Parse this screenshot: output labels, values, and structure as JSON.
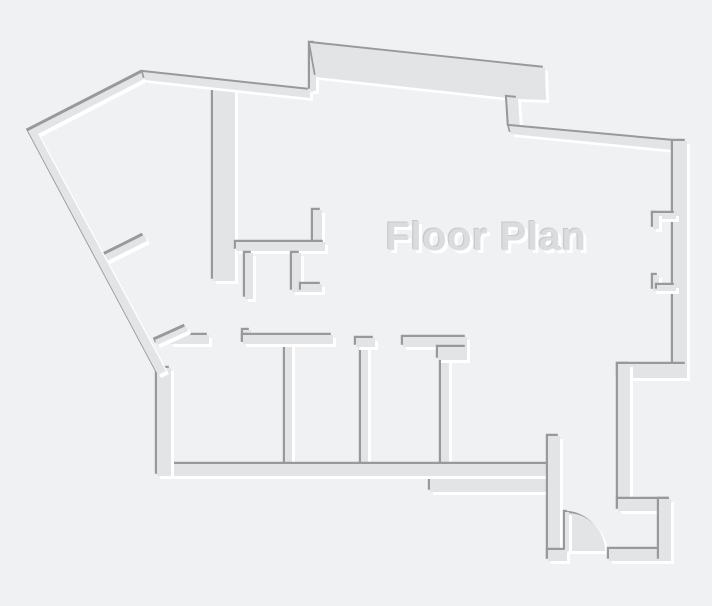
{
  "title": "Floor Plan",
  "canvas": {
    "width": 712,
    "height": 606
  },
  "palette": {
    "background": "#f0f1f2",
    "wall_fill": "#e3e4e5",
    "shadow_dark": "#98999b",
    "highlight": "#ffffff",
    "title_fill": "#dadcde",
    "title_dark_edge": "#c7c9cb",
    "title_highlight": "#ffffff"
  },
  "emboss": {
    "dark_dx": -2.2,
    "dark_dy": -2.2,
    "light_dx": 3,
    "light_dy": 3
  },
  "text": {
    "x": 486,
    "y": 250,
    "font_size": 40,
    "hi_dx": 3,
    "hi_dy": 3,
    "dk_dx": -1.2,
    "dk_dy": -1.2
  },
  "walls": [
    {
      "name": "nw-angled-partition",
      "type": "poly",
      "points": [
        [
          104,
          255
        ],
        [
          144,
          235
        ],
        [
          147,
          241
        ],
        [
          107,
          261
        ]
      ]
    },
    {
      "name": "center-thick-wall",
      "type": "rect",
      "x": 213,
      "y": 88,
      "w": 22,
      "h": 193
    },
    {
      "name": "closet-wall-vertical",
      "type": "rect",
      "x": 313,
      "y": 210,
      "w": 9,
      "h": 33
    },
    {
      "name": "closet-wall-horizontal",
      "type": "rect",
      "x": 236,
      "y": 242,
      "w": 89,
      "h": 9
    },
    {
      "name": "closet-stub-left",
      "type": "rect",
      "x": 245,
      "y": 253,
      "w": 8,
      "h": 46
    },
    {
      "name": "closet-stub-right-vertical",
      "type": "rect",
      "x": 292,
      "y": 253,
      "w": 9,
      "h": 39
    },
    {
      "name": "closet-stub-right-horizontal",
      "type": "rect",
      "x": 301,
      "y": 284,
      "w": 21,
      "h": 8
    },
    {
      "name": "room-divider-1",
      "type": "rect",
      "x": 285,
      "y": 343,
      "w": 7,
      "h": 123
    },
    {
      "name": "room-divider-2",
      "type": "rect",
      "x": 361,
      "y": 346,
      "w": 7,
      "h": 120
    },
    {
      "name": "room-divider-3",
      "type": "rect",
      "x": 441,
      "y": 358,
      "w": 8,
      "h": 108
    },
    {
      "name": "rooms-top-wall-a",
      "type": "rect",
      "x": 170,
      "y": 335,
      "w": 39,
      "h": 9
    },
    {
      "name": "rooms-top-angled-stub",
      "type": "poly",
      "points": [
        [
          155,
          340
        ],
        [
          186,
          326
        ],
        [
          188,
          331
        ],
        [
          157,
          345
        ]
      ]
    },
    {
      "name": "rooms-top-wall-b-hook",
      "type": "rect",
      "x": 243,
      "y": 330,
      "w": 8,
      "h": 14
    },
    {
      "name": "rooms-top-wall-b",
      "type": "rect",
      "x": 243,
      "y": 335,
      "w": 90,
      "h": 9
    },
    {
      "name": "rooms-top-stub-2",
      "type": "rect",
      "x": 356,
      "y": 338,
      "w": 19,
      "h": 9
    },
    {
      "name": "rooms-top-wall-c",
      "type": "rect",
      "x": 403,
      "y": 337,
      "w": 64,
      "h": 10
    },
    {
      "name": "rooms-top-wall-c-block",
      "type": "rect",
      "x": 438,
      "y": 347,
      "w": 29,
      "h": 13
    },
    {
      "name": "entry-lower-wall-band",
      "type": "rect",
      "x": 430,
      "y": 474,
      "w": 130,
      "h": 18
    },
    {
      "name": "rooms-bottom-wall",
      "type": "rect",
      "x": 158,
      "y": 464,
      "w": 402,
      "h": 12
    },
    {
      "name": "rooms-left-wall",
      "type": "rect",
      "x": 157,
      "y": 368,
      "w": 14,
      "h": 108
    },
    {
      "name": "entry-partition-wall",
      "type": "rect",
      "x": 548,
      "y": 436,
      "w": 12,
      "h": 125
    },
    {
      "name": "door-swing-arc",
      "type": "path",
      "d": "M567,513 A38,38 0 0 1 605,551 L567,551 Z"
    },
    {
      "name": "door-leaf",
      "type": "rect",
      "x": 565,
      "y": 512,
      "w": 4,
      "h": 39
    },
    {
      "name": "entry-bottom-wall-left",
      "type": "rect",
      "x": 548,
      "y": 550,
      "w": 19,
      "h": 11
    },
    {
      "name": "entry-bottom-wall-right",
      "type": "rect",
      "x": 609,
      "y": 549,
      "w": 62,
      "h": 12
    },
    {
      "name": "outline-west-walls",
      "type": "poly",
      "points": [
        [
          143,
          72
        ],
        [
          28,
          131
        ],
        [
          158,
          375
        ],
        [
          166,
          371
        ],
        [
          38,
          134
        ],
        [
          146,
          78
        ]
      ]
    },
    {
      "name": "outline-top-wall",
      "type": "poly",
      "points": [
        [
          143,
          72
        ],
        [
          310,
          90
        ],
        [
          310,
          98
        ],
        [
          145,
          80
        ]
      ]
    },
    {
      "name": "band-left-edge",
      "type": "rect",
      "x": 310,
      "y": 43,
      "w": 6,
      "h": 48
    },
    {
      "name": "top-band",
      "type": "poly",
      "points": [
        [
          310,
          43
        ],
        [
          545,
          68
        ],
        [
          546,
          100
        ],
        [
          517,
          99
        ],
        [
          316,
          77
        ]
      ]
    },
    {
      "name": "band-jog",
      "type": "poly",
      "points": [
        [
          507,
          97
        ],
        [
          518,
          98
        ],
        [
          520,
          128
        ],
        [
          509,
          128
        ]
      ]
    },
    {
      "name": "outline-ne-diagonal",
      "type": "poly",
      "points": [
        [
          509,
          126
        ],
        [
          685,
          142
        ],
        [
          683,
          151
        ],
        [
          511,
          134
        ]
      ]
    },
    {
      "name": "outline-east-wall",
      "type": "rect",
      "x": 673,
      "y": 141,
      "w": 14,
      "h": 237
    },
    {
      "name": "window-jamb-top-horizontal",
      "type": "rect",
      "x": 653,
      "y": 213,
      "w": 23,
      "h": 6
    },
    {
      "name": "window-jamb-top-vertical",
      "type": "rect",
      "x": 653,
      "y": 213,
      "w": 6,
      "h": 16
    },
    {
      "name": "window-jamb-bottom-vertical",
      "type": "rect",
      "x": 653,
      "y": 275,
      "w": 6,
      "h": 16
    },
    {
      "name": "window-jamb-bottom-horizontal",
      "type": "rect",
      "x": 657,
      "y": 285,
      "w": 19,
      "h": 6
    },
    {
      "name": "step-wall-h1",
      "type": "rect",
      "x": 618,
      "y": 364,
      "w": 69,
      "h": 14
    },
    {
      "name": "step-wall-v1",
      "type": "rect",
      "x": 618,
      "y": 364,
      "w": 12,
      "h": 147
    },
    {
      "name": "step-wall-h2",
      "type": "rect",
      "x": 618,
      "y": 499,
      "w": 53,
      "h": 12
    },
    {
      "name": "step-wall-v2",
      "type": "rect",
      "x": 659,
      "y": 499,
      "w": 12,
      "h": 62
    }
  ]
}
